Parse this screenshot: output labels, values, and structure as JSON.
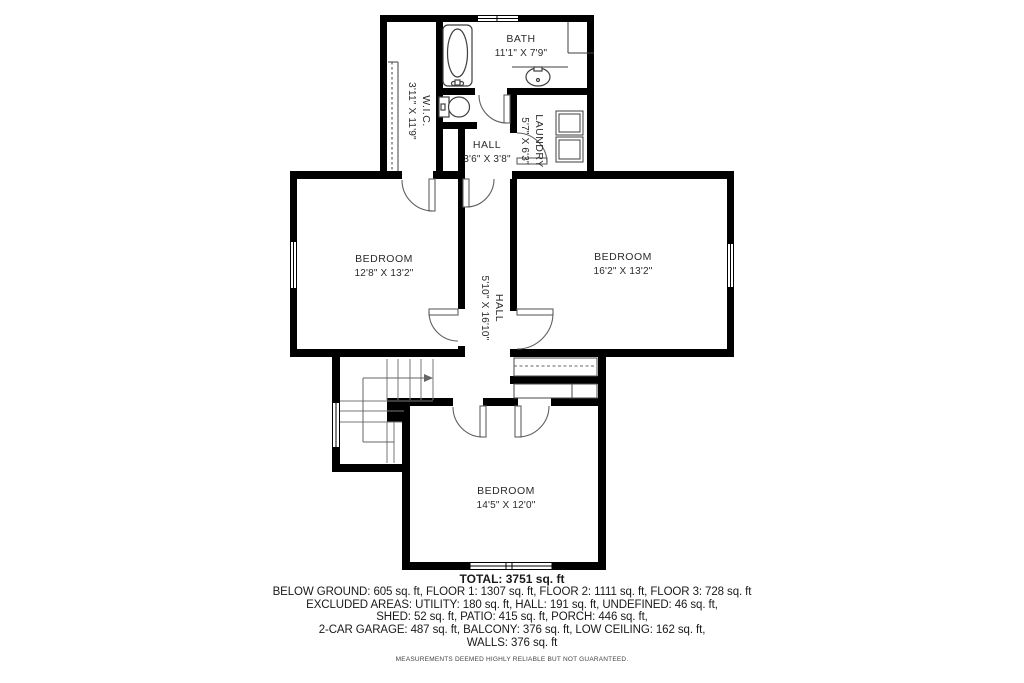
{
  "rooms": {
    "wic": {
      "name": "W.I.C.",
      "dims": "3'11\" X 11'9\""
    },
    "bath": {
      "name": "BATH",
      "dims": "11'1\" X 7'9\""
    },
    "hall_upper": {
      "name": "HALL",
      "dims": "3'6\" X 3'8\""
    },
    "laundry": {
      "name": "LAUNDRY",
      "dims": "5'7\" X 6'3\""
    },
    "bedroom_left": {
      "name": "BEDROOM",
      "dims": "12'8\" X 13'2\""
    },
    "hall_main": {
      "name": "HALL",
      "dims": "5'10\" X 16'10\""
    },
    "bedroom_right": {
      "name": "BEDROOM",
      "dims": "16'2\" X 13'2\""
    },
    "bedroom_bottom": {
      "name": "BEDROOM",
      "dims": "14'5\" X 12'0\""
    }
  },
  "summary": {
    "total": "TOTAL: 3751 sq. ft",
    "lines": [
      "BELOW GROUND: 605 sq. ft, FLOOR 1: 1307 sq. ft, FLOOR 2: 1111 sq. ft, FLOOR 3: 728 sq. ft",
      "EXCLUDED AREAS: UTILITY: 180 sq. ft, HALL: 191 sq. ft, UNDEFINED: 46 sq. ft,",
      "SHED: 52 sq. ft, PATIO: 415 sq. ft, PORCH: 446 sq. ft,",
      "2-CAR GARAGE: 487 sq. ft, BALCONY: 376 sq. ft, LOW CEILING: 162 sq. ft,",
      "WALLS: 376 sq. ft"
    ],
    "disclaimer": "MEASUREMENTS DEEMED HIGHLY RELIABLE BUT NOT GUARANTEED."
  },
  "colors": {
    "wall": "#000000",
    "fixture": "#3f3f3f",
    "door": "#606060",
    "stair": "#777777",
    "text": "#2b2b2b"
  }
}
